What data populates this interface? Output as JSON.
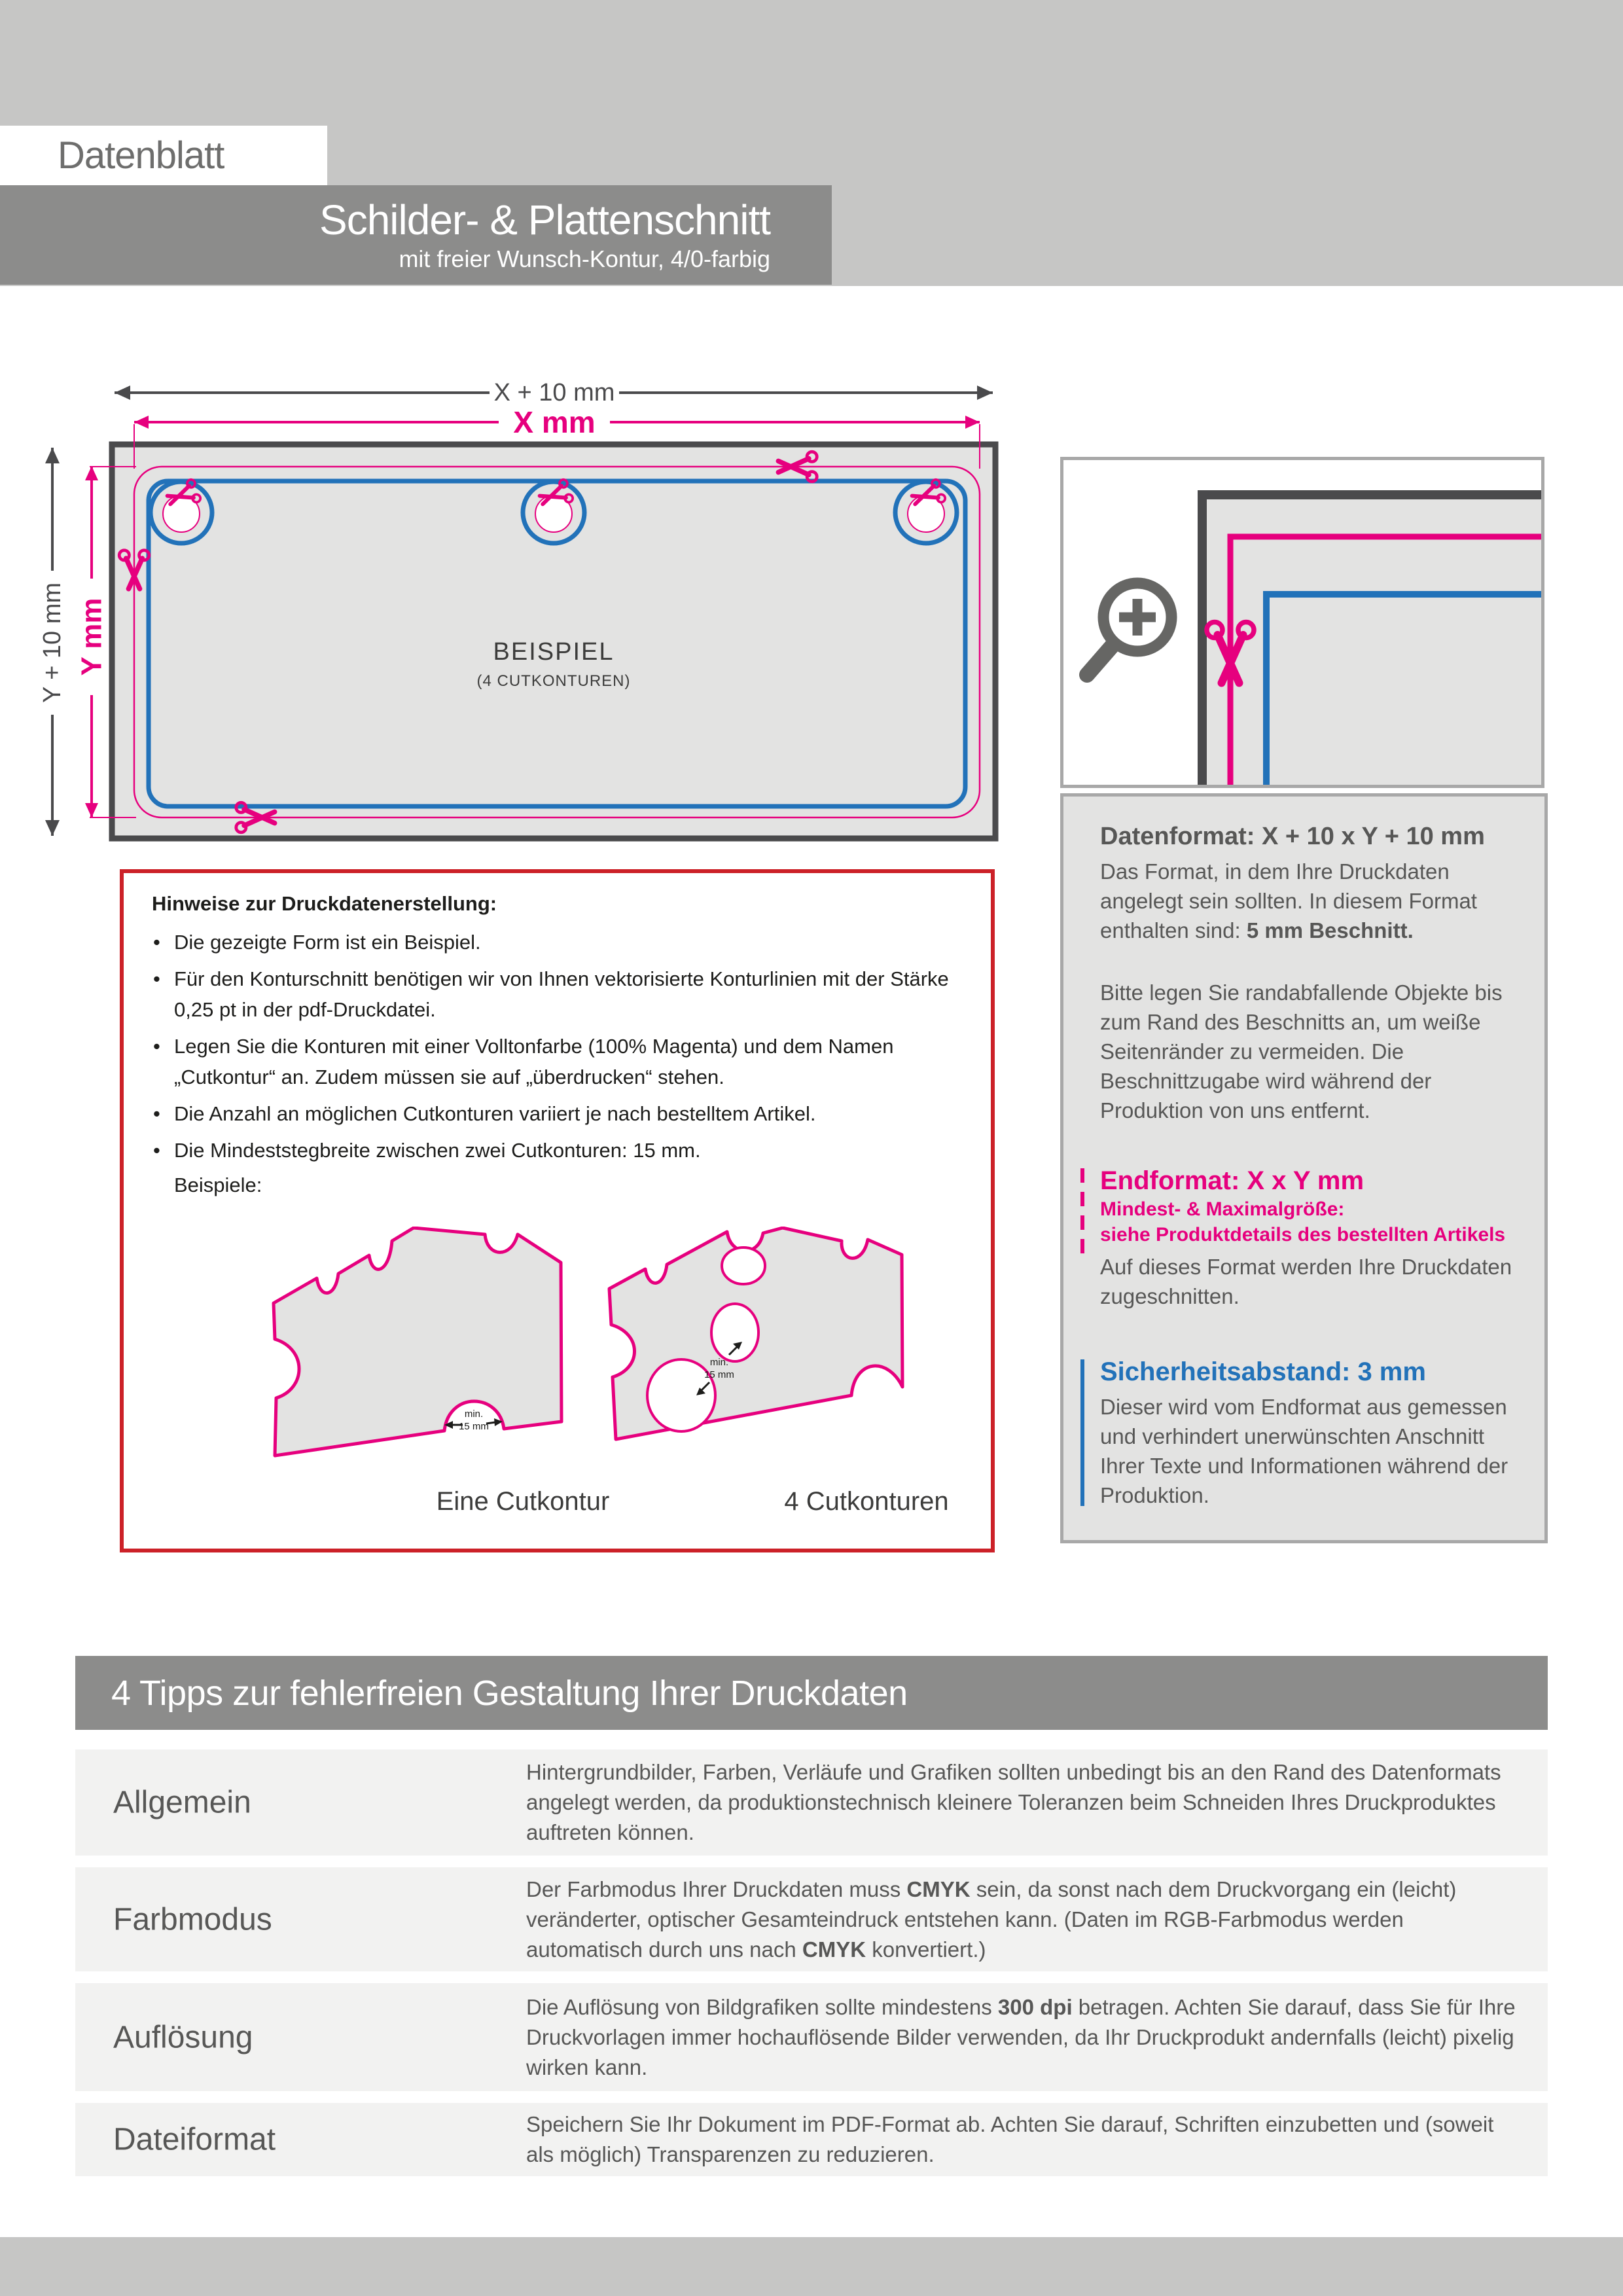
{
  "header": {
    "label": "Datenblatt",
    "title": "Schilder- & Plattenschnitt",
    "subtitle": "mit freier Wunsch-Kontur, 4/0-farbig"
  },
  "diagram": {
    "dim_outer_width": "X + 10 mm",
    "dim_inner_width": "X mm",
    "dim_outer_height": "Y + 10 mm",
    "dim_inner_height": "Y mm",
    "plate_label": "BEISPIEL",
    "plate_sublabel": "(4 CUTKONTUREN)"
  },
  "hinweise": {
    "title": "Hinweise zur Druckdatenerstellung:",
    "bullets": [
      "Die gezeigte Form ist ein Beispiel.",
      "Für den Konturschnitt benötigen wir von Ihnen vektorisierte Konturlinien mit der Stärke 0,25 pt in der pdf-Druckdatei.",
      "Legen Sie die Konturen mit einer Volltonfarbe (100% Magenta) und dem Namen „Cutkontur“ an. Zudem müssen sie auf „überdrucken“ stehen.",
      "Die Anzahl an möglichen Cutkonturen variiert je nach bestelltem Artikel.",
      "Die Mindeststegbreite zwischen zwei Cutkonturen: 15 mm."
    ],
    "examples_label": "Beispiele:",
    "example1_caption": "Eine Cutkontur",
    "example2_caption": "4 Cutkonturen",
    "min_label_line1": "min.",
    "min_label_line2": "15 mm"
  },
  "info_panel": {
    "datenformat_heading": "Datenformat: X + 10 x Y + 10 mm",
    "datenformat_p1": [
      {
        "t": "Das Format, in dem Ihre Druckdaten angelegt sein sollten. In diesem Format enthalten sind: ",
        "b": false
      },
      {
        "t": "5 mm Beschnitt.",
        "b": true
      }
    ],
    "datenformat_p2": "Bitte legen Sie randabfallende Objekte bis zum Rand des Beschnitts an, um weiße Seitenränder zu vermeiden. Die Beschnittzugabe wird während der Produktion von uns entfernt.",
    "endformat_heading": "Endformat: X x Y mm",
    "endformat_sub1": "Mindest- & Maximalgröße:",
    "endformat_sub2": "siehe Produktdetails des bestellten Artikels",
    "endformat_p": "Auf dieses Format werden Ihre Druckdaten zugeschnitten.",
    "sicherheit_heading": "Sicherheitsabstand: 3 mm",
    "sicherheit_p": "Dieser wird vom Endformat aus gemessen und verhindert unerwünschten Anschnitt Ihrer Texte und Informationen während der Produktion."
  },
  "tips": {
    "heading": "4 Tipps zur fehlerfreien Gestaltung Ihrer Druckdaten",
    "rows": [
      {
        "label": "Allgemein",
        "segments": [
          {
            "t": "Hintergrundbilder, Farben, Verläufe und Grafiken sollten unbedingt bis an den Rand des Datenformats angelegt werden, da produktionstechnisch kleinere Toleranzen beim Schneiden Ihres Druckproduktes auftreten können.",
            "b": false
          }
        ]
      },
      {
        "label": "Farbmodus",
        "segments": [
          {
            "t": "Der Farbmodus Ihrer Druckdaten muss ",
            "b": false
          },
          {
            "t": "CMYK",
            "b": true
          },
          {
            "t": " sein, da sonst nach dem Druckvorgang ein (leicht) veränderter, optischer Gesamteindruck entstehen kann. (Daten im RGB-Farbmodus werden automatisch durch uns nach ",
            "b": false
          },
          {
            "t": "CMYK",
            "b": true
          },
          {
            "t": " konvertiert.)",
            "b": false
          }
        ]
      },
      {
        "label": "Auflösung",
        "segments": [
          {
            "t": "Die Auflösung von Bildgrafiken sollte mindestens ",
            "b": false
          },
          {
            "t": "300 dpi",
            "b": true
          },
          {
            "t": " betragen. Achten Sie darauf, dass Sie für Ihre Druckvorlagen immer hochauflösende Bilder verwenden, da Ihr Druckprodukt andernfalls (leicht) pixelig wirken kann.",
            "b": false
          }
        ]
      },
      {
        "label": "Dateiformat",
        "segments": [
          {
            "t": "Speichern Sie Ihr Dokument im PDF-Format ab. Achten Sie darauf, Schriften einzubetten und (soweit als möglich) Transparenzen zu reduzieren.",
            "b": false
          }
        ]
      }
    ]
  },
  "colors": {
    "magenta": "#e6007e",
    "blue": "#2272b9",
    "red_border": "#cc2128",
    "dark_gray": "#4a4a4c",
    "text_gray": "#575756",
    "band_gray": "#c6c6c5",
    "title_band": "#8c8c8b",
    "plate_fill": "#e3e3e2",
    "row_bg": "#f2f2f1"
  }
}
